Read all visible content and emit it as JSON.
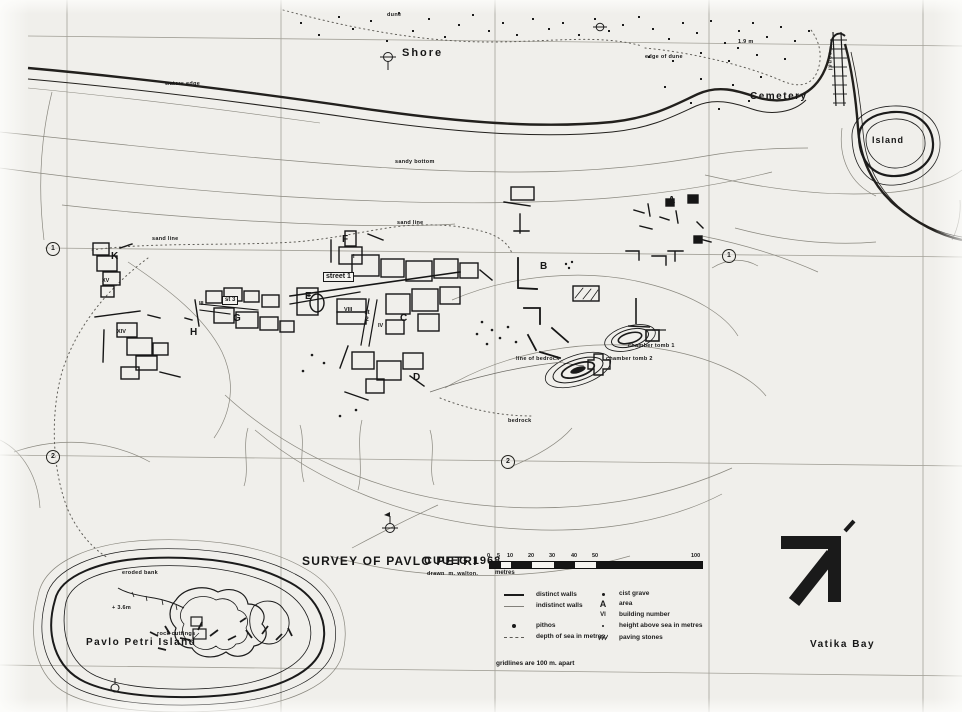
{
  "colors": {
    "paper": "#f0efeb",
    "ink": "#1b1b1b",
    "contour_gray": "#8a887f",
    "grid_gray": "#a3a198"
  },
  "title_block": {
    "title": "SURVEY OF PAVLO PETRI",
    "org_year": "CUUEG 1968",
    "credit": "drawn  m. walton."
  },
  "scale_bar": {
    "ticks": [
      "0",
      "5",
      "10",
      "20",
      "30",
      "40",
      "50",
      "100"
    ],
    "unit": "metres"
  },
  "legend": {
    "left_items": [
      {
        "icon": "distinct-walls-line",
        "label": "distinct walls"
      },
      {
        "icon": "indistinct-walls-line",
        "label": "indistinct walls"
      },
      {
        "icon": "pithos-dot",
        "label": "pithos"
      },
      {
        "icon": "sea-depth-dash",
        "label": "depth of sea in metres"
      }
    ],
    "right_items": [
      {
        "icon": "cist-grave-dot",
        "symbol": "",
        "label": "cist grave"
      },
      {
        "icon": "area-letter",
        "symbol": "A",
        "label": "area"
      },
      {
        "icon": "building-number-numeral",
        "symbol": "VI",
        "label": "building number"
      },
      {
        "icon": "height-dot",
        "symbol": "",
        "label": "height above sea in metres"
      },
      {
        "icon": "paving-stones-hatch",
        "symbol": "",
        "label": "paving stones"
      }
    ],
    "footnote": "gridlines are 100 m. apart"
  },
  "place_labels": {
    "shore": "Shore",
    "cemetery": "Cemetery",
    "island": "Island",
    "pavlo_petri_island": "Pavlo Petri Island",
    "vatika_bay": "Vatika Bay"
  },
  "feature_labels": {
    "dune": "dune",
    "edge_of_dune": "edge of dune",
    "height_dune": "1.9 m",
    "canal": "canal",
    "waters_edge": "waters edge",
    "sandy_bottom": "sandy bottom",
    "sand_line_left": "sand line",
    "sand_line_mid": "sand line",
    "street_1": "street 1",
    "st_3": "st 3",
    "st_2": "st 2",
    "line_of_bedrock": "line of bedrock",
    "chamber_tomb_1": "chamber tomb 1",
    "chamber_tomb_2": "chamber tomb 2",
    "bedrock": "bedrock",
    "eroded_bank": "eroded bank",
    "height_island": "+ 3.6m",
    "rock_cuttings": "rock cuttings"
  },
  "area_letters": [
    "A",
    "B",
    "C",
    "D",
    "E",
    "F",
    "G",
    "H",
    "K"
  ],
  "building_numbers": [
    "I",
    "VIII",
    "IV",
    "III",
    "XV",
    "XIV",
    "III"
  ],
  "grid_numbers": [
    "1",
    "1",
    "2",
    "2"
  ]
}
